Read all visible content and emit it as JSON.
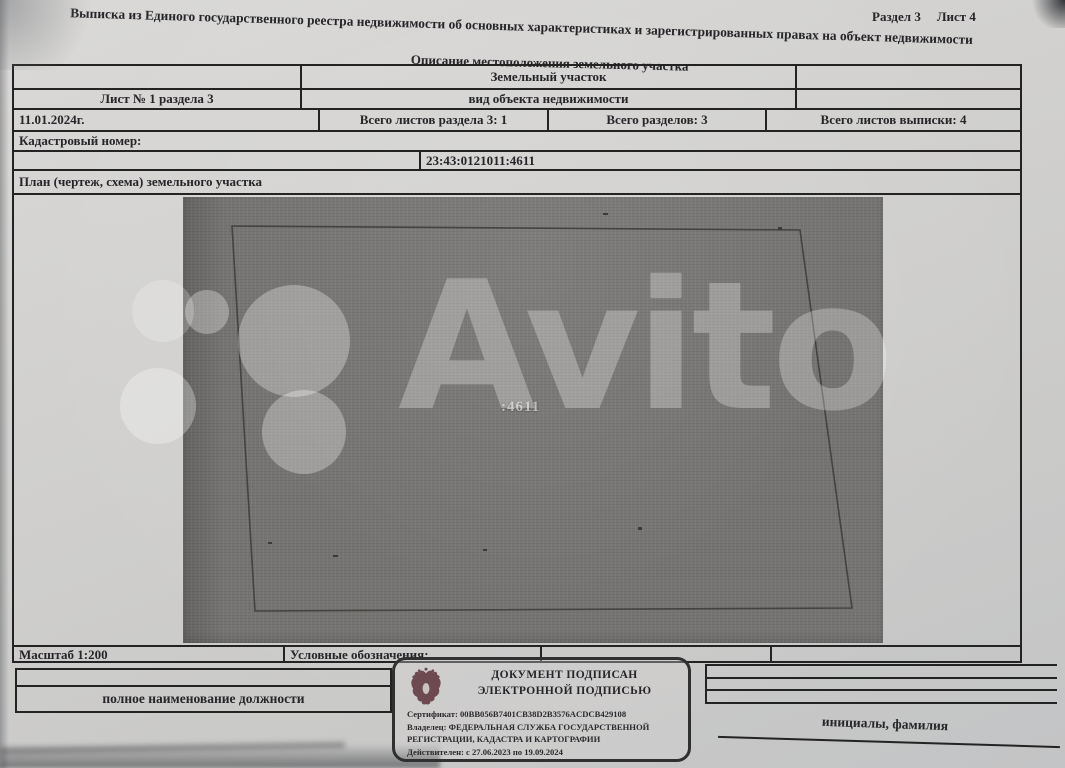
{
  "page": {
    "section_info": "Раздел 3",
    "sheet_info": "Лист 4",
    "title": "Выписка из Единого государственного реестра недвижимости об основных характеристиках и зарегистрированных правах на объект недвижимости",
    "subtitle": "Описание местоположения земельного участка"
  },
  "table": {
    "object_type_value": "Земельный участок",
    "object_type_caption": "вид объекта недвижимости",
    "sheet_number": "Лист № 1 раздела 3",
    "date": "11.01.2024г.",
    "total_sheets_section": "Всего листов раздела 3: 1",
    "total_sections": "Всего разделов: 3",
    "total_sheets_extract": "Всего листов выписки: 4",
    "cadastral_label": "Кадастровый номер:",
    "cadastral_number": "23:43:0121011:4611",
    "plan_label": "План (чертеж, схема) земельного участка",
    "scale_label": "Масштаб 1:200",
    "legend_label": "Условные обозначения:"
  },
  "plan": {
    "parcel_label": ":4611"
  },
  "watermark": {
    "text": "Avito"
  },
  "signature": {
    "position_caption": "полное наименование должности",
    "name_caption": "инициалы, фамилия",
    "stamp": {
      "line1": "ДОКУМЕНТ ПОДПИСАН",
      "line2": "ЭЛЕКТРОННОЙ ПОДПИСЬЮ",
      "certificate": "Сертификат: 00BB056B7401CB38D2B3576ACDCB429108",
      "owner_line1": "Владелец: ФЕДЕРАЛЬНАЯ СЛУЖБА ГОСУДАРСТВЕННОЙ",
      "owner_line2": "РЕГИСТРАЦИИ, КАДАСТРА И КАРТОГРАФИИ",
      "validity": "Действителен: с 27.06.2023 по 19.09.2024"
    }
  },
  "colors": {
    "paper": "#d2d1cf",
    "ink": "#26262a",
    "plan_background": "#767472",
    "stamp_emblem": "#6d4a50",
    "watermark": "#ffffff"
  }
}
